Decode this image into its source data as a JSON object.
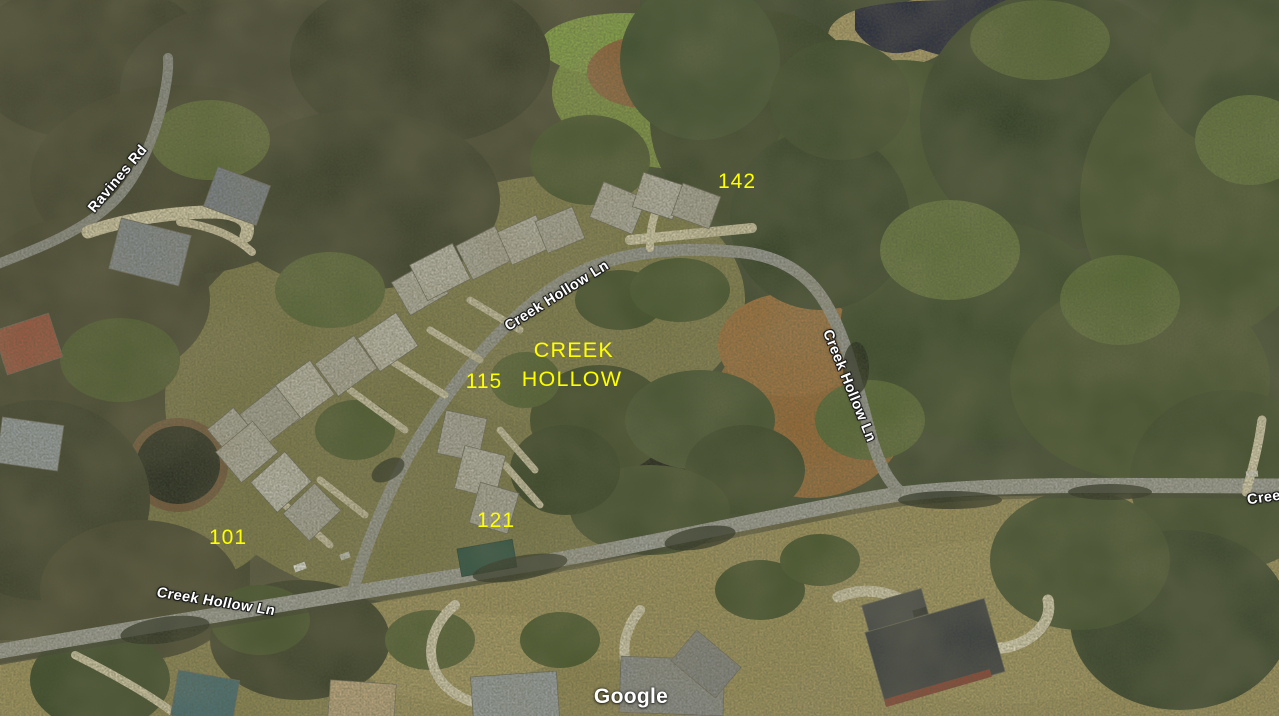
{
  "map": {
    "view_type": "satellite-aerial",
    "attribution": "Google",
    "annotations": {
      "development_name_line1": "CREEK",
      "development_name_line2": "HOLLOW",
      "lot_101": "101",
      "lot_115": "115",
      "lot_121": "121",
      "lot_142": "142"
    },
    "road_labels": {
      "ravines_rd": "Ravines Rd",
      "creek_hollow_ln_upper": "Creek Hollow Ln",
      "creek_hollow_ln_right": "Creek Hollow Ln",
      "creek_hollow_ln_lower": "Creek Hollow Ln",
      "creek_hollow_ln_partial": "Cree"
    },
    "colors": {
      "annotation_yellow": "#ffff00",
      "road_label_text": "#ffffff",
      "road_label_outline": "#1c1c1c",
      "attribution_text": "#ffffff",
      "pond_water": "#1d1f3a",
      "road_surface": "#a3a39f"
    }
  }
}
